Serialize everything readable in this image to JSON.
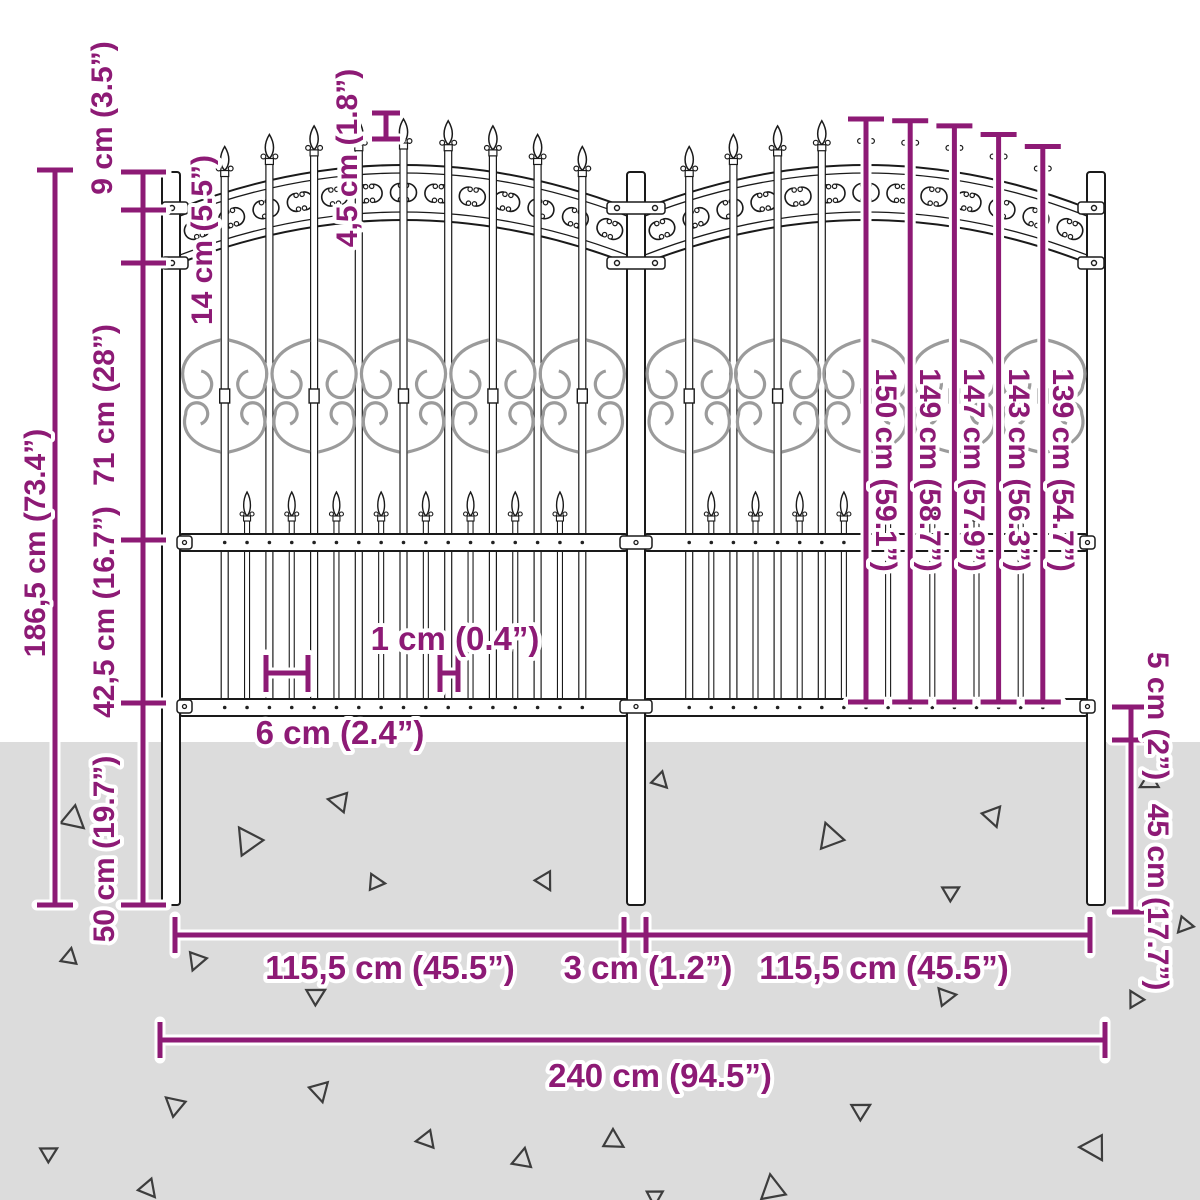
{
  "diagram": {
    "title": "Garden fence with spear top - dimension diagram",
    "colors": {
      "accent": "#8d1a75",
      "ground": "#dcdcdc",
      "line": "#1a1a1a",
      "scroll_gray": "#9b9b9b",
      "fill_white": "#ffffff",
      "triangle": "#3d3d3d"
    },
    "fence": {
      "posts": 3,
      "panels": 2
    },
    "dimensions": {
      "post_above_band": "9 cm (3.5”)",
      "band_height": "14 cm (5.5”)",
      "spike_step": "4,5 cm (1.8”)",
      "upper_section": "71 cm (28”)",
      "lower_section": "42,5 cm (16.7”)",
      "below_bottom_rail": "50 cm (19.7”)",
      "total_height": "186,5 cm (73.4”)",
      "bar_height_1": "150 cm (59.1”)",
      "bar_height_2": "149 cm (58.7”)",
      "bar_height_3": "147 cm (57.9”)",
      "bar_height_4": "143 cm (56.3”)",
      "bar_height_5": "139 cm (54.7”)",
      "bar_gap": "1 cm (0.4”)",
      "bar_spacing": "6 cm (2.4”)",
      "rail_to_ground": "5 cm (2”)",
      "spike_depth": "45 cm (17.7”)",
      "left_panel_width": "115,5 cm (45.5”)",
      "post_gap": "3 cm (1.2”)",
      "right_panel_width": "115,5 cm (45.5”)",
      "total_width": "240 cm (94.5”)"
    },
    "ground_triangles": [
      [
        73,
        818,
        13,
        10
      ],
      [
        248,
        842,
        15,
        205
      ],
      [
        340,
        802,
        11,
        160
      ],
      [
        375,
        882,
        9,
        335
      ],
      [
        545,
        880,
        10,
        30
      ],
      [
        660,
        780,
        9,
        15
      ],
      [
        830,
        838,
        14,
        220
      ],
      [
        950,
        892,
        9,
        300
      ],
      [
        993,
        815,
        11,
        40
      ],
      [
        1150,
        782,
        10,
        120
      ],
      [
        69,
        958,
        9,
        250
      ],
      [
        197,
        960,
        10,
        80
      ],
      [
        315,
        995,
        10,
        300
      ],
      [
        175,
        1106,
        11,
        190
      ],
      [
        48,
        1153,
        9,
        300
      ],
      [
        148,
        1188,
        10,
        20
      ],
      [
        320,
        1090,
        11,
        45
      ],
      [
        427,
        1140,
        10,
        140
      ],
      [
        522,
        1160,
        11,
        250
      ],
      [
        613,
        1140,
        11,
        0
      ],
      [
        655,
        1196,
        9,
        60
      ],
      [
        772,
        1190,
        14,
        230
      ],
      [
        945,
        996,
        10,
        320
      ],
      [
        1135,
        1000,
        9,
        210
      ],
      [
        1095,
        1148,
        14,
        150
      ],
      [
        860,
        1110,
        10,
        300
      ],
      [
        1185,
        925,
        9,
        100
      ]
    ]
  }
}
